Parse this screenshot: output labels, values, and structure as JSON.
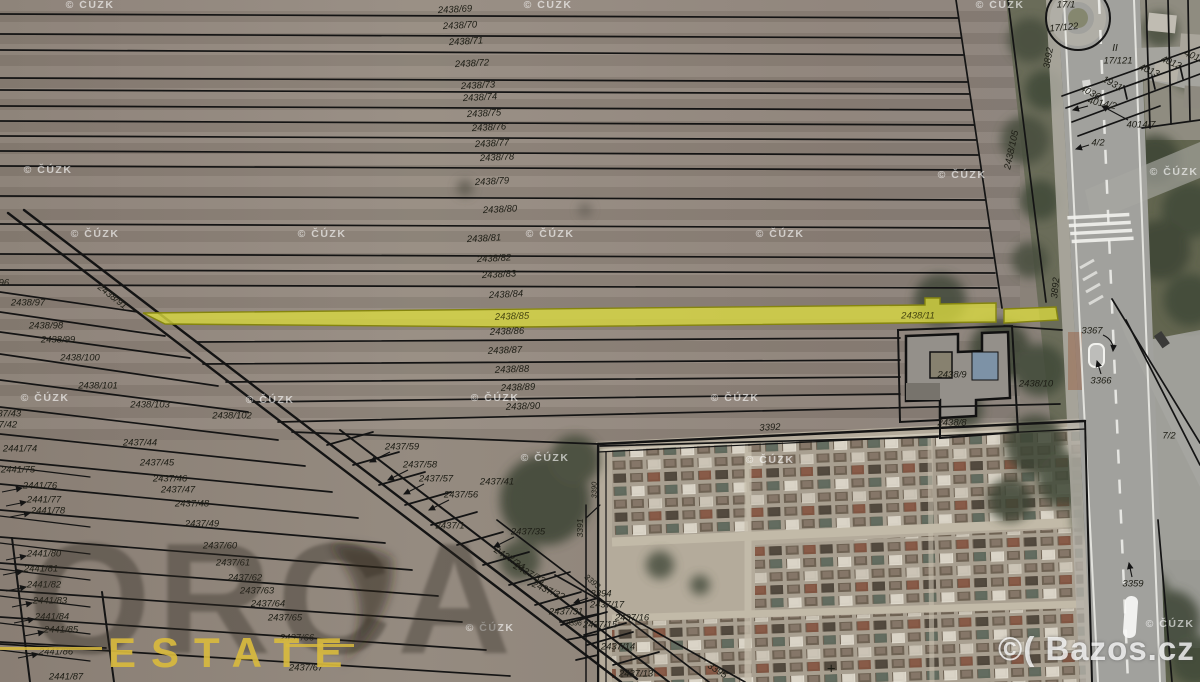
{
  "map": {
    "source_attribution": "© ČÚZK",
    "bazos_watermark": "©( Bazos.cz",
    "orca_watermark": {
      "brand": "ORCA",
      "sub": "ESTATE"
    },
    "highlight": {
      "parcel": "2438/85",
      "parcel_right": "2438/11",
      "fill": "#d8d840",
      "stroke": "#85850f"
    },
    "labels": [
      {
        "t": "2438/69",
        "x": 455,
        "y": 10,
        "r": -3
      },
      {
        "t": "2438/70",
        "x": 460,
        "y": 26,
        "r": -3
      },
      {
        "t": "2438/71",
        "x": 466,
        "y": 42,
        "r": -3
      },
      {
        "t": "2438/72",
        "x": 472,
        "y": 64,
        "r": -3
      },
      {
        "t": "2438/73",
        "x": 478,
        "y": 86,
        "r": -3
      },
      {
        "t": "2438/74",
        "x": 480,
        "y": 98,
        "r": -3
      },
      {
        "t": "2438/75",
        "x": 484,
        "y": 114,
        "r": -3
      },
      {
        "t": "2438/76",
        "x": 489,
        "y": 128,
        "r": -3
      },
      {
        "t": "2438/77",
        "x": 492,
        "y": 144,
        "r": -3
      },
      {
        "t": "2438/78",
        "x": 497,
        "y": 158,
        "r": -3
      },
      {
        "t": "2438/79",
        "x": 492,
        "y": 182,
        "r": -3
      },
      {
        "t": "2438/80",
        "x": 500,
        "y": 210,
        "r": -3
      },
      {
        "t": "2438/81",
        "x": 484,
        "y": 239,
        "r": -3
      },
      {
        "t": "2438/82",
        "x": 494,
        "y": 259,
        "r": -3
      },
      {
        "t": "2438/83",
        "x": 499,
        "y": 275,
        "r": -3
      },
      {
        "t": "2438/84",
        "x": 506,
        "y": 295,
        "r": -3
      },
      {
        "t": "2438/85",
        "x": 512,
        "y": 317,
        "r": -2,
        "c": "#45450f"
      },
      {
        "t": "2438/86",
        "x": 507,
        "y": 332,
        "r": -2
      },
      {
        "t": "2438/87",
        "x": 505,
        "y": 351,
        "r": -2
      },
      {
        "t": "2438/88",
        "x": 512,
        "y": 370,
        "r": -2
      },
      {
        "t": "2438/89",
        "x": 518,
        "y": 388,
        "r": -2
      },
      {
        "t": "2438/90",
        "x": 523,
        "y": 407,
        "r": -2
      },
      {
        "t": "2438/96",
        "x": -8,
        "y": 283
      },
      {
        "t": "2438/97",
        "x": 28,
        "y": 303
      },
      {
        "t": "2438/98",
        "x": 46,
        "y": 326
      },
      {
        "t": "2438/99",
        "x": 58,
        "y": 340
      },
      {
        "t": "2438/100",
        "x": 80,
        "y": 358
      },
      {
        "t": "2438/101",
        "x": 98,
        "y": 386
      },
      {
        "t": "2438/103",
        "x": 150,
        "y": 405
      },
      {
        "t": "2438/102",
        "x": 232,
        "y": 416
      },
      {
        "t": "2438/91",
        "x": 112,
        "y": 297,
        "r": 38
      },
      {
        "t": "2438/105",
        "x": 1012,
        "y": 150,
        "r": -78
      },
      {
        "t": "2437/43",
        "x": 4,
        "y": 414
      },
      {
        "t": "2437/42",
        "x": 0,
        "y": 425
      },
      {
        "t": "2441/74",
        "x": 20,
        "y": 449
      },
      {
        "t": "2441/75",
        "x": 18,
        "y": 470
      },
      {
        "t": "2441/76",
        "x": 40,
        "y": 486
      },
      {
        "t": "2441/77",
        "x": 44,
        "y": 500
      },
      {
        "t": "2441/78",
        "x": 48,
        "y": 511
      },
      {
        "t": "2441/80",
        "x": 44,
        "y": 554
      },
      {
        "t": "2441/81",
        "x": 41,
        "y": 569
      },
      {
        "t": "2441/82",
        "x": 44,
        "y": 585
      },
      {
        "t": "2441/83",
        "x": 50,
        "y": 601
      },
      {
        "t": "2441/84",
        "x": 52,
        "y": 617
      },
      {
        "t": "2441/85",
        "x": 61,
        "y": 630
      },
      {
        "t": "2441/86",
        "x": 56,
        "y": 652
      },
      {
        "t": "2441/87",
        "x": 66,
        "y": 677
      },
      {
        "t": "2437/44",
        "x": 140,
        "y": 443
      },
      {
        "t": "2437/45",
        "x": 157,
        "y": 463
      },
      {
        "t": "2437/46",
        "x": 170,
        "y": 479
      },
      {
        "t": "2437/47",
        "x": 178,
        "y": 490
      },
      {
        "t": "2437/48",
        "x": 192,
        "y": 504
      },
      {
        "t": "2437/49",
        "x": 202,
        "y": 524
      },
      {
        "t": "2437/60",
        "x": 220,
        "y": 546
      },
      {
        "t": "2437/61",
        "x": 233,
        "y": 563
      },
      {
        "t": "2437/62",
        "x": 245,
        "y": 578
      },
      {
        "t": "2437/63",
        "x": 257,
        "y": 591
      },
      {
        "t": "2437/64",
        "x": 268,
        "y": 604
      },
      {
        "t": "2437/65",
        "x": 285,
        "y": 618
      },
      {
        "t": "2437/66",
        "x": 297,
        "y": 638
      },
      {
        "t": "2437/67",
        "x": 306,
        "y": 668
      },
      {
        "t": "2437/59",
        "x": 402,
        "y": 447
      },
      {
        "t": "2437/58",
        "x": 420,
        "y": 465
      },
      {
        "t": "2437/57",
        "x": 436,
        "y": 479
      },
      {
        "t": "2437/56",
        "x": 461,
        "y": 495
      },
      {
        "t": "2437/41",
        "x": 497,
        "y": 482
      },
      {
        "t": "2437/1",
        "x": 450,
        "y": 526
      },
      {
        "t": "2437/35",
        "x": 528,
        "y": 532
      },
      {
        "t": "2437/34",
        "x": 509,
        "y": 559,
        "r": 33
      },
      {
        "t": "2437/33",
        "x": 529,
        "y": 574,
        "r": 28
      },
      {
        "t": "2437/32",
        "x": 548,
        "y": 591,
        "r": 24
      },
      {
        "t": "2437/31",
        "x": 566,
        "y": 612
      },
      {
        "t": "3394",
        "x": 601,
        "y": 594
      },
      {
        "t": "3393",
        "x": 592,
        "y": 582,
        "r": 40,
        "s": 8
      },
      {
        "t": "2437/17",
        "x": 607,
        "y": 605
      },
      {
        "t": "2437/16",
        "x": 632,
        "y": 618
      },
      {
        "t": "3396",
        "x": 574,
        "y": 624,
        "s": 7
      },
      {
        "t": "2437/15",
        "x": 600,
        "y": 625
      },
      {
        "t": "2437/14",
        "x": 618,
        "y": 647
      },
      {
        "t": "2437/13",
        "x": 636,
        "y": 674
      },
      {
        "t": "3395",
        "x": 717,
        "y": 671,
        "r": 33
      },
      {
        "t": "3392",
        "x": 770,
        "y": 428,
        "r": -3
      },
      {
        "t": "3391",
        "x": 580,
        "y": 528,
        "r": -90,
        "s": 8.5
      },
      {
        "t": "3390",
        "x": 594,
        "y": 490,
        "r": -90,
        "s": 7.5
      },
      {
        "t": "+",
        "x": 831,
        "y": 669,
        "s": 15
      },
      {
        "t": "3892",
        "x": 1049,
        "y": 58,
        "r": -80
      },
      {
        "t": "17/1",
        "x": 1066,
        "y": 5
      },
      {
        "t": "17/122",
        "x": 1064,
        "y": 28,
        "r": -5
      },
      {
        "t": "II",
        "x": 1115,
        "y": 49,
        "s": 10
      },
      {
        "t": "17/121",
        "x": 1118,
        "y": 61
      },
      {
        "t": "4013",
        "x": 1149,
        "y": 71,
        "r": 22
      },
      {
        "t": "4012",
        "x": 1171,
        "y": 63,
        "r": 22
      },
      {
        "t": "4011",
        "x": 1194,
        "y": 57,
        "r": 22
      },
      {
        "t": "4036",
        "x": 1090,
        "y": 93,
        "r": 28
      },
      {
        "t": "1931",
        "x": 1112,
        "y": 84,
        "r": 28
      },
      {
        "t": "4014/2",
        "x": 1102,
        "y": 104,
        "r": 12
      },
      {
        "t": "4014/7",
        "x": 1141,
        "y": 125
      },
      {
        "t": "4/2",
        "x": 1098,
        "y": 143
      },
      {
        "t": "3892",
        "x": 1056,
        "y": 288,
        "r": -84
      },
      {
        "t": "3367",
        "x": 1092,
        "y": 331
      },
      {
        "t": "3366",
        "x": 1101,
        "y": 381
      },
      {
        "t": "7/2",
        "x": 1169,
        "y": 436
      },
      {
        "t": "3359",
        "x": 1133,
        "y": 584
      },
      {
        "t": "2438/11",
        "x": 918,
        "y": 316,
        "c": "#45450f"
      },
      {
        "t": "2438/9",
        "x": 952,
        "y": 375
      },
      {
        "t": "2438/10",
        "x": 1036,
        "y": 384
      },
      {
        "t": "2438/8",
        "x": 952,
        "y": 423
      }
    ],
    "cuzk_positions": [
      {
        "x": 90,
        "y": 5
      },
      {
        "x": 548,
        "y": 5
      },
      {
        "x": 1000,
        "y": 5
      },
      {
        "x": 48,
        "y": 170
      },
      {
        "x": 962,
        "y": 175
      },
      {
        "x": 1174,
        "y": 172
      },
      {
        "x": 95,
        "y": 234
      },
      {
        "x": 322,
        "y": 234
      },
      {
        "x": 550,
        "y": 234
      },
      {
        "x": 780,
        "y": 234
      },
      {
        "x": 45,
        "y": 398
      },
      {
        "x": 270,
        "y": 400
      },
      {
        "x": 495,
        "y": 398
      },
      {
        "x": 735,
        "y": 398
      },
      {
        "x": 545,
        "y": 458
      },
      {
        "x": 770,
        "y": 460
      },
      {
        "x": 490,
        "y": 628
      },
      {
        "x": 1170,
        "y": 624
      }
    ]
  }
}
